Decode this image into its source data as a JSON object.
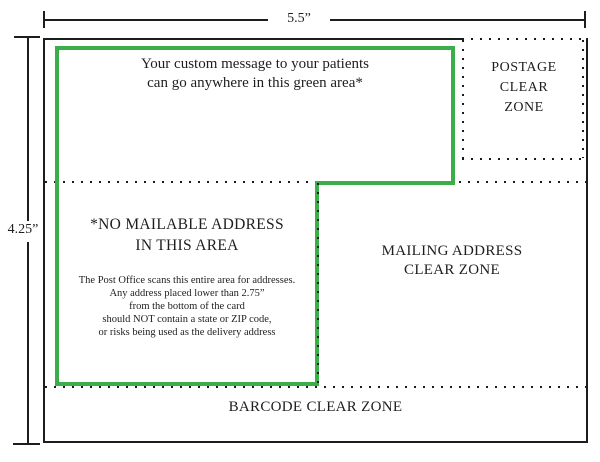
{
  "dimensions": {
    "width_label": "5.5”",
    "height_label": "4.25”"
  },
  "zones": {
    "custom_message": {
      "line1": "Your custom message to your patients",
      "line2": "can go anywhere in this green area*"
    },
    "postage": {
      "line1": "POSTAGE",
      "line2": "CLEAR",
      "line3": "ZONE"
    },
    "no_mailable": {
      "heading_line1": "*NO MAILABLE ADDRESS",
      "heading_line2": "IN THIS AREA",
      "body_line1": "The Post Office scans this entire area for addresses.",
      "body_line2": "Any address placed lower than 2.75”",
      "body_line3": "from the bottom of the card",
      "body_line4": "should NOT contain a state or ZIP code,",
      "body_line5": "or risks being used as the delivery address"
    },
    "mailing": {
      "line1": "MAILING ADDRESS",
      "line2": "CLEAR ZONE"
    },
    "barcode": {
      "label": "BARCODE CLEAR ZONE"
    }
  },
  "colors": {
    "green_border": "#3bae4b",
    "line": "#1d1d1d"
  }
}
